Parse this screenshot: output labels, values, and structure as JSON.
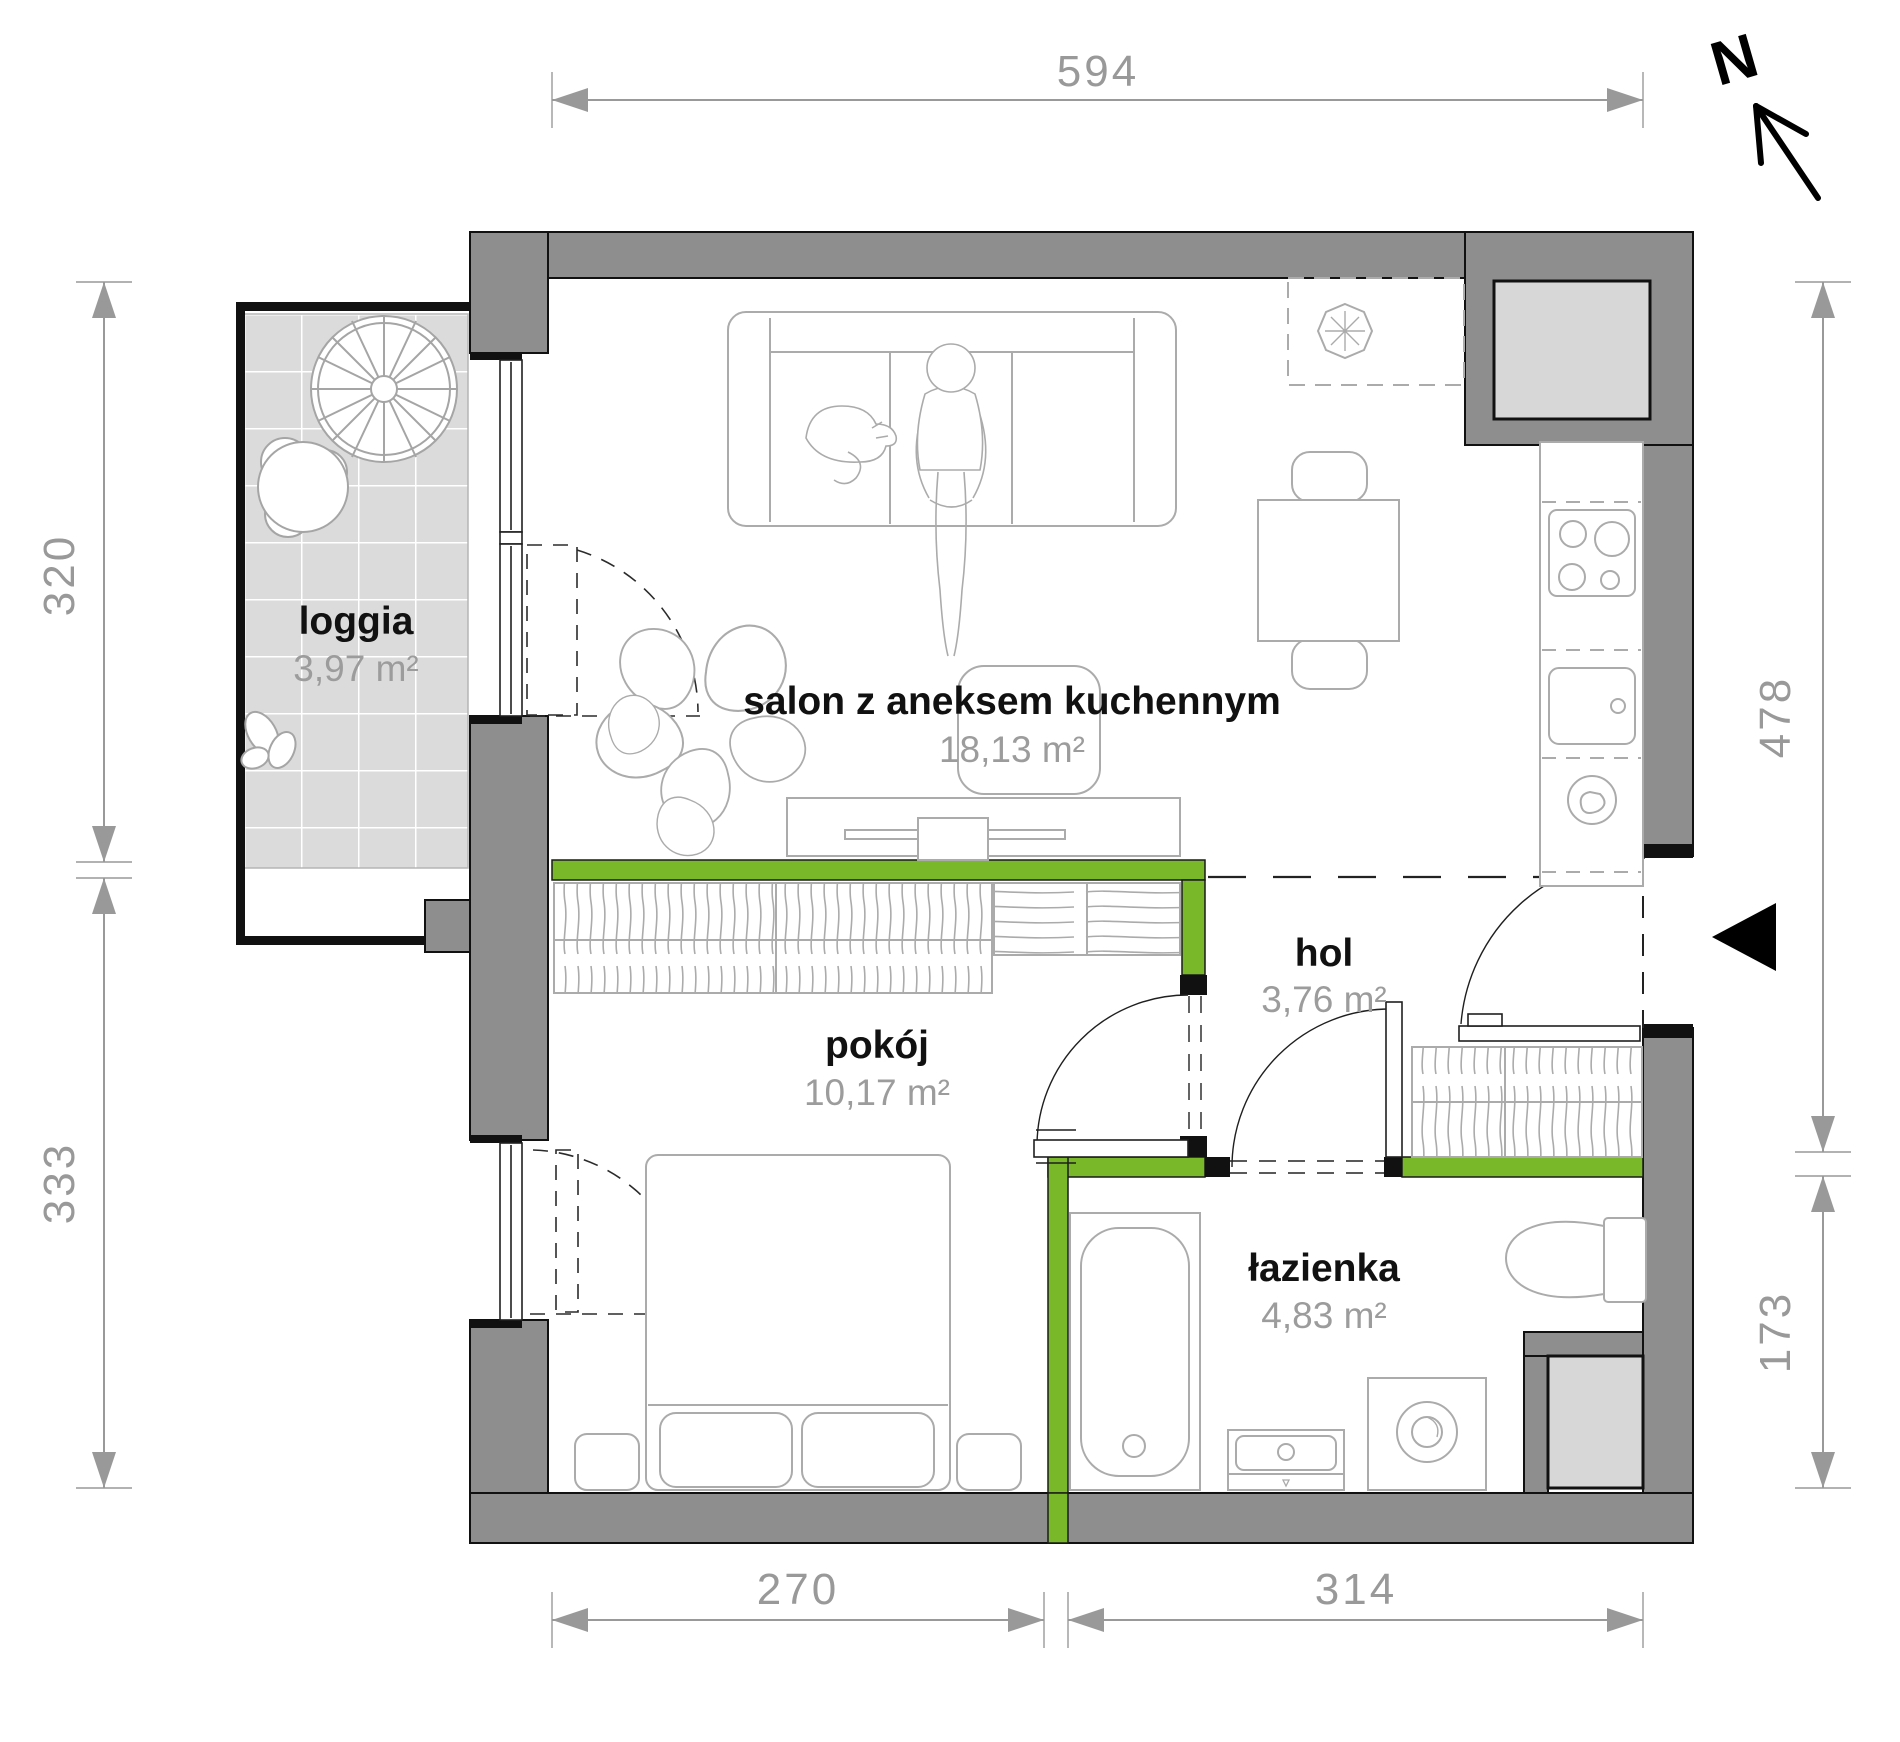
{
  "rooms": {
    "loggia": {
      "name": "loggia",
      "area": "3,97 m²"
    },
    "salon": {
      "name": "salon z aneksem kuchennym",
      "area": "18,13 m²"
    },
    "pokoj": {
      "name": "pokój",
      "area": "10,17 m²"
    },
    "hol": {
      "name": "hol",
      "area": "3,76 m²"
    },
    "lazienka": {
      "name": "łazienka",
      "area": "4,83 m²"
    }
  },
  "dimensions_cm": {
    "top": "594",
    "left_upper": "320",
    "left_lower": "333",
    "right_upper": "478",
    "right_lower": "173",
    "bottom_left": "270",
    "bottom_right": "314"
  },
  "compass": {
    "north_label": "N"
  },
  "colors": {
    "wall": "#8e8e8e",
    "partition": "#79b829",
    "tile_floor": "#dbdbdb",
    "shaft_fill": "#d7d7d7",
    "dimension": "#999999",
    "furniture_stroke": "#ababab"
  }
}
